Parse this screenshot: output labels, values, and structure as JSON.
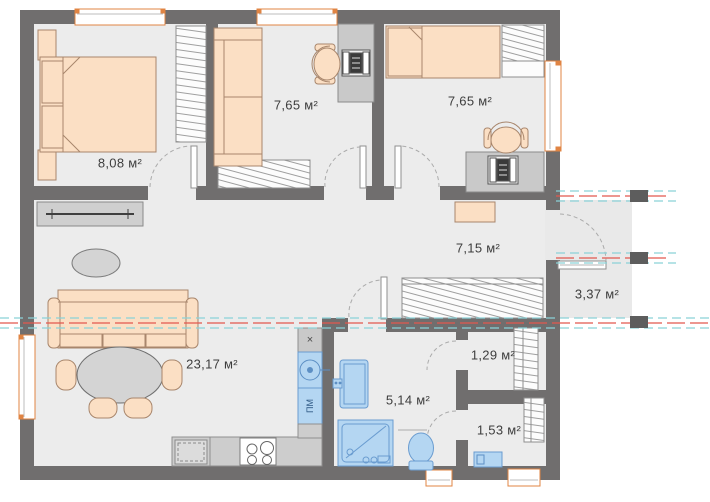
{
  "floor_plan": {
    "rooms": {
      "bedroom_main": {
        "name": "bedroom-main",
        "area": "8,08 м²"
      },
      "room_middle": {
        "name": "room-middle",
        "area": "7,65 м²"
      },
      "bedroom_right": {
        "name": "bedroom-right",
        "area": "7,65 м²"
      },
      "hallway": {
        "name": "hallway",
        "area": "7,15 м²"
      },
      "balcony": {
        "name": "balcony",
        "area": "3,37 м²"
      },
      "living_kitchen": {
        "name": "living-kitchen",
        "area": "23,17 м²"
      },
      "closet": {
        "name": "closet",
        "area": "1,29 м²"
      },
      "bathroom": {
        "name": "bathroom",
        "area": "5,14 м²"
      },
      "wc": {
        "name": "wc",
        "area": "1,53 м²"
      }
    },
    "appliances": {
      "dishwasher_label": "ПМ",
      "vent_symbol": "×"
    },
    "colors": {
      "wall": "#706e6e",
      "pillar": "#5d5d5d",
      "floor": "#ececec",
      "furniture_fill": "#fbdfc4",
      "furniture_stroke": "#a8866c",
      "gray_furniture": "#cfcfcf",
      "fixture_fill": "#b4d6f2",
      "fixture_stroke": "#6a9cd0",
      "window_frame": "#e08443",
      "section_line_red": "#e2574e",
      "section_line_cyan": "#8ad2d8",
      "label_text": "#3d3d3d"
    }
  }
}
